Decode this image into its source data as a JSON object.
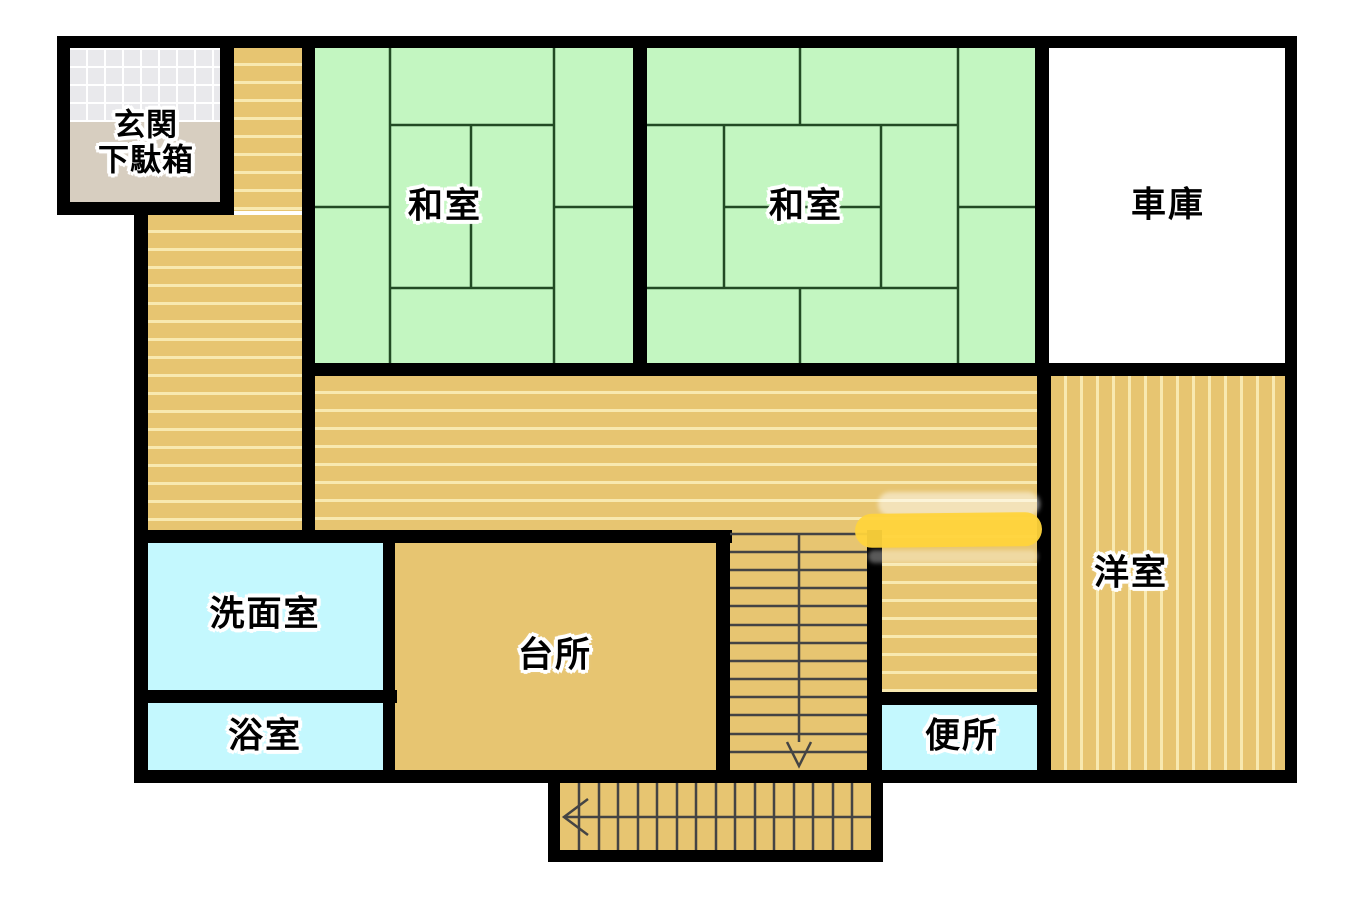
{
  "plan": {
    "type": "floor-plan",
    "floor_labels": {
      "genkan": {
        "line1": "玄関",
        "line2": "下駄箱"
      },
      "washitsu1": {
        "label": "和室"
      },
      "washitsu2": {
        "label": "和室"
      },
      "garage": {
        "label": "車庫"
      },
      "senmenshitsu": {
        "label": "洗面室"
      },
      "yokushitsu": {
        "label": "浴室"
      },
      "daidokoro": {
        "label": "台所"
      },
      "benjo": {
        "label": "便所"
      },
      "youshitsu": {
        "label": "洋室"
      }
    },
    "colors": {
      "background": "#ffffff",
      "wall": "#000000",
      "tatami": "#c3f6c1",
      "tatamiLine": "#224a24",
      "floorTan": "#e7c571",
      "floorStripe": "#f8e9b0",
      "waterCyan": "#c4f8fe",
      "tileGray": "#e9e9ec",
      "tileGrout": "#ffffff",
      "genkanFloor": "#d7cec0",
      "garageWhite": "#ffffff",
      "markerYellow": "#ffd43b",
      "stairLine": "#444444"
    }
  }
}
